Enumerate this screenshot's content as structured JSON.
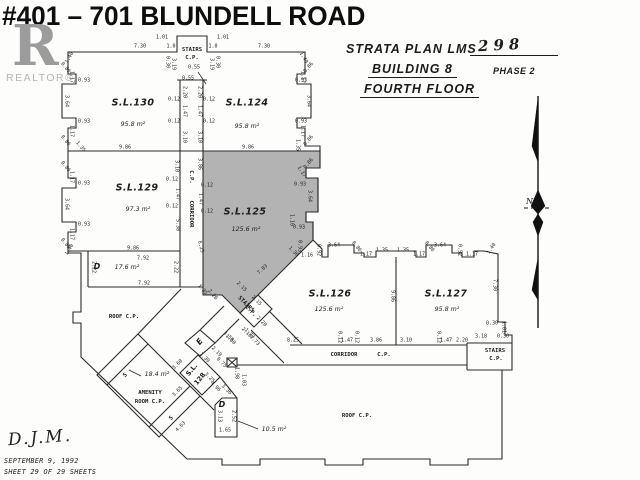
{
  "title": "#401 – 701 BLUNDELL ROAD",
  "logo": {
    "letter": "R",
    "brand": "REALTOR®"
  },
  "plan_header": {
    "line1_label": "STRATA PLAN LMS",
    "line1_value": "298",
    "line2": "BUILDING 8",
    "phase": "PHASE 2",
    "line3": "FOURTH FLOOR"
  },
  "footer": {
    "signature": "D.J.M.",
    "date": "SEPTEMBER 9, 1992",
    "sheet": "SHEET 29 OF 29 SHEETS"
  },
  "colors": {
    "ink": "#2b2b2b",
    "shaded_unit": "#b3b3b3",
    "logo_gray": "#9c9c9c"
  },
  "rooms": [
    {
      "name": "S.L.130",
      "area": "95.8 m²",
      "nx": 133,
      "ny": 103,
      "ax": 133,
      "ay": 125
    },
    {
      "name": "S.L.124",
      "area": "95.8 m²",
      "nx": 247,
      "ny": 103,
      "ax": 247,
      "ay": 127
    },
    {
      "name": "S.L.129",
      "area": "97.3 m²",
      "nx": 137,
      "ny": 188,
      "ax": 138,
      "ay": 210
    },
    {
      "name": "S.L.125",
      "area": "125.6 m²",
      "nx": 245,
      "ny": 212,
      "ax": 246,
      "ay": 230
    },
    {
      "name": "S.L.126",
      "area": "125.6 m²",
      "nx": 330,
      "ny": 294,
      "ax": 329,
      "ay": 310
    },
    {
      "name": "S.L.127",
      "area": "95.8 m²",
      "nx": 446,
      "ny": 294,
      "ax": 447,
      "ay": 310
    }
  ],
  "small_labels": [
    {
      "t": "STAIRS",
      "x": 192,
      "y": 51,
      "cls": "rm"
    },
    {
      "t": "C.P.",
      "x": 192,
      "y": 59,
      "cls": "rm"
    },
    {
      "t": "C.P.",
      "x": 190,
      "y": 177,
      "r": 90,
      "cls": "rm"
    },
    {
      "t": "CORRIDOR",
      "x": 190,
      "y": 214,
      "r": 90,
      "cls": "rm"
    },
    {
      "t": "CORRIDOR",
      "x": 344,
      "y": 356,
      "cls": "rm"
    },
    {
      "t": "C.P.",
      "x": 384,
      "y": 356,
      "cls": "rm"
    },
    {
      "t": "STAIRS",
      "x": 495,
      "y": 352,
      "cls": "rm"
    },
    {
      "t": "C.P.",
      "x": 496,
      "y": 360,
      "cls": "rm"
    },
    {
      "t": "STAIRS",
      "x": 245,
      "y": 305,
      "r": 45,
      "cls": "rm"
    },
    {
      "t": "C.P.",
      "x": 250,
      "y": 312,
      "r": 45,
      "cls": "rm"
    },
    {
      "t": "ROOF C.P.",
      "x": 124,
      "y": 318,
      "cls": "rm"
    },
    {
      "t": "ROOF C.P.",
      "x": 357,
      "y": 417,
      "cls": "rm"
    },
    {
      "t": "AMENITY",
      "x": 150,
      "y": 394,
      "cls": "rm"
    },
    {
      "t": "ROOM C.P.",
      "x": 150,
      "y": 403,
      "cls": "rm"
    },
    {
      "t": "18.4 m²",
      "x": 157,
      "y": 375,
      "cls": "area-sm"
    },
    {
      "t": "10.5 m²",
      "x": 274,
      "y": 430,
      "cls": "area-sm"
    },
    {
      "t": "17.6 m²",
      "x": 127,
      "y": 268,
      "cls": "area-sm"
    },
    {
      "t": "D",
      "x": 97,
      "y": 267,
      "cls": "bold"
    },
    {
      "t": "D",
      "x": 222,
      "y": 405,
      "cls": "bold"
    },
    {
      "t": "E",
      "x": 200,
      "y": 342,
      "r": -50,
      "cls": "bold"
    },
    {
      "t": "S.L.",
      "x": 192,
      "y": 370,
      "r": -50,
      "cls": "bold-sm"
    },
    {
      "t": "128",
      "x": 200,
      "y": 379,
      "r": -50,
      "cls": "bold-sm"
    },
    {
      "t": "S",
      "x": 126,
      "y": 376,
      "r": -45,
      "cls": "rm"
    },
    {
      "t": "S",
      "x": 172,
      "y": 419,
      "r": -45,
      "cls": "rm"
    }
  ],
  "dimensions": [
    {
      "t": "7.30",
      "x": 140,
      "y": 47
    },
    {
      "t": "1.01",
      "x": 162,
      "y": 38
    },
    {
      "t": "1.0",
      "x": 171,
      "y": 47
    },
    {
      "t": "0.30",
      "x": 167,
      "y": 62,
      "r": 90
    },
    {
      "t": "3.19",
      "x": 173,
      "y": 64,
      "r": 90
    },
    {
      "t": "3.19",
      "x": 211,
      "y": 64,
      "r": 90
    },
    {
      "t": "0.30",
      "x": 217,
      "y": 62,
      "r": 90
    },
    {
      "t": "1.0",
      "x": 213,
      "y": 47
    },
    {
      "t": "1.01",
      "x": 223,
      "y": 38
    },
    {
      "t": "7.30",
      "x": 264,
      "y": 47
    },
    {
      "t": "1.40",
      "x": 70,
      "y": 58,
      "r": -60
    },
    {
      "t": "1.40",
      "x": 303,
      "y": 58,
      "r": 60
    },
    {
      "t": "0.55",
      "x": 194,
      "y": 68
    },
    {
      "t": "0.55",
      "x": 188,
      "y": 79
    },
    {
      "t": "2.20",
      "x": 184,
      "y": 92,
      "r": 90
    },
    {
      "t": "2.20",
      "x": 199,
      "y": 92,
      "r": 90
    },
    {
      "t": "0.12",
      "x": 174,
      "y": 100
    },
    {
      "t": "0.12",
      "x": 209,
      "y": 100
    },
    {
      "t": "1.47",
      "x": 184,
      "y": 111,
      "r": 90
    },
    {
      "t": "1.47",
      "x": 199,
      "y": 111,
      "r": 90
    },
    {
      "t": "0.12",
      "x": 174,
      "y": 122
    },
    {
      "t": "0.12",
      "x": 209,
      "y": 122
    },
    {
      "t": "3.10",
      "x": 184,
      "y": 137,
      "r": 90
    },
    {
      "t": "3.10",
      "x": 199,
      "y": 137,
      "r": 90
    },
    {
      "t": "0.86",
      "x": 65,
      "y": 68,
      "r": 50
    },
    {
      "t": "1.17",
      "x": 71,
      "y": 77,
      "r": 90
    },
    {
      "t": "0.93",
      "x": 84,
      "y": 81
    },
    {
      "t": "3.64",
      "x": 66,
      "y": 101,
      "r": 90
    },
    {
      "t": "0.93",
      "x": 84,
      "y": 122
    },
    {
      "t": "1.17",
      "x": 71,
      "y": 131,
      "r": 90
    },
    {
      "t": "0.86",
      "x": 65,
      "y": 141,
      "r": 50
    },
    {
      "t": "1.35",
      "x": 80,
      "y": 147,
      "r": 50
    },
    {
      "t": "0.86",
      "x": 309,
      "y": 68,
      "r": -50
    },
    {
      "t": "1.17",
      "x": 302,
      "y": 77,
      "r": 90
    },
    {
      "t": "0.93",
      "x": 301,
      "y": 81
    },
    {
      "t": "3.64",
      "x": 308,
      "y": 101,
      "r": 90
    },
    {
      "t": "0.93",
      "x": 301,
      "y": 122
    },
    {
      "t": "1.17",
      "x": 302,
      "y": 131,
      "r": 90
    },
    {
      "t": "0.86",
      "x": 309,
      "y": 141,
      "r": -50
    },
    {
      "t": "1.35",
      "x": 297,
      "y": 145,
      "r": 90
    },
    {
      "t": "9.86",
      "x": 125,
      "y": 148
    },
    {
      "t": "9.86",
      "x": 248,
      "y": 148
    },
    {
      "t": "0.86",
      "x": 65,
      "y": 167,
      "r": 50
    },
    {
      "t": "1.17",
      "x": 71,
      "y": 177,
      "r": 90
    },
    {
      "t": "0.93",
      "x": 84,
      "y": 184
    },
    {
      "t": "3.64",
      "x": 66,
      "y": 204,
      "r": 90
    },
    {
      "t": "0.93",
      "x": 84,
      "y": 225
    },
    {
      "t": "1.17",
      "x": 71,
      "y": 234,
      "r": 90
    },
    {
      "t": "0.86",
      "x": 65,
      "y": 244,
      "r": 50
    },
    {
      "t": "1.40",
      "x": 70,
      "y": 250,
      "r": -60
    },
    {
      "t": "3.10",
      "x": 176,
      "y": 166,
      "r": 90
    },
    {
      "t": "3.86",
      "x": 199,
      "y": 164,
      "r": 90
    },
    {
      "t": "0.12",
      "x": 172,
      "y": 180
    },
    {
      "t": "0.12",
      "x": 207,
      "y": 186
    },
    {
      "t": "1.47",
      "x": 177,
      "y": 194,
      "r": 90
    },
    {
      "t": "1.47",
      "x": 200,
      "y": 199,
      "r": 90
    },
    {
      "t": "0.12",
      "x": 172,
      "y": 207
    },
    {
      "t": "0.12",
      "x": 207,
      "y": 212
    },
    {
      "t": "5.38",
      "x": 177,
      "y": 225,
      "r": 90
    },
    {
      "t": "6.25",
      "x": 200,
      "y": 247,
      "r": 75
    },
    {
      "t": "0.86",
      "x": 309,
      "y": 164,
      "r": -50
    },
    {
      "t": "1.17",
      "x": 301,
      "y": 172,
      "r": 60
    },
    {
      "t": "0.93",
      "x": 300,
      "y": 185
    },
    {
      "t": "3.64",
      "x": 309,
      "y": 196,
      "r": 90
    },
    {
      "t": "1.16",
      "x": 291,
      "y": 220,
      "r": 90
    },
    {
      "t": "0.93",
      "x": 299,
      "y": 228
    },
    {
      "t": "7.83",
      "x": 263,
      "y": 270,
      "r": -44
    },
    {
      "t": "1.35",
      "x": 202,
      "y": 290,
      "r": 50
    },
    {
      "t": "2.20",
      "x": 212,
      "y": 295,
      "r": 50
    },
    {
      "t": "2.15",
      "x": 241,
      "y": 287,
      "r": 45
    },
    {
      "t": "2.15",
      "x": 256,
      "y": 301,
      "r": 45
    },
    {
      "t": "2.20",
      "x": 261,
      "y": 322,
      "r": 45
    },
    {
      "t": "2.10",
      "x": 246,
      "y": 333,
      "r": 45
    },
    {
      "t": "1.73",
      "x": 254,
      "y": 341,
      "r": 45
    },
    {
      "t": "1.50",
      "x": 228,
      "y": 337,
      "r": 45
    },
    {
      "t": "1.36",
      "x": 293,
      "y": 252,
      "r": 45
    },
    {
      "t": "1.16",
      "x": 307,
      "y": 256
    },
    {
      "t": "0.93",
      "x": 299,
      "y": 246,
      "r": 90
    },
    {
      "t": "0.92",
      "x": 318,
      "y": 250,
      "r": 90
    },
    {
      "t": "3.64",
      "x": 334,
      "y": 246
    },
    {
      "t": "0.86",
      "x": 356,
      "y": 247,
      "r": 50
    },
    {
      "t": "1.17",
      "x": 366,
      "y": 255
    },
    {
      "t": "1.35",
      "x": 382,
      "y": 251
    },
    {
      "t": "1.35",
      "x": 403,
      "y": 251
    },
    {
      "t": "1.17",
      "x": 419,
      "y": 255
    },
    {
      "t": "0.86",
      "x": 429,
      "y": 247,
      "r": 50
    },
    {
      "t": "3.64",
      "x": 440,
      "y": 246
    },
    {
      "t": "0.92",
      "x": 459,
      "y": 250,
      "r": 90
    },
    {
      "t": "1.17",
      "x": 472,
      "y": 255
    },
    {
      "t": "1.40",
      "x": 492,
      "y": 249,
      "r": -55
    },
    {
      "t": "9.86",
      "x": 392,
      "y": 296,
      "r": 90
    },
    {
      "t": "7.30",
      "x": 494,
      "y": 285,
      "r": 90
    },
    {
      "t": "8.25",
      "x": 293,
      "y": 341
    },
    {
      "t": "0.12",
      "x": 339,
      "y": 337,
      "r": 90
    },
    {
      "t": "1.47",
      "x": 347,
      "y": 341
    },
    {
      "t": "0.12",
      "x": 356,
      "y": 337,
      "r": 90
    },
    {
      "t": "3.86",
      "x": 376,
      "y": 341
    },
    {
      "t": "3.10",
      "x": 406,
      "y": 341
    },
    {
      "t": "0.12",
      "x": 438,
      "y": 337,
      "r": 90
    },
    {
      "t": "1.47",
      "x": 446,
      "y": 341
    },
    {
      "t": "2.20",
      "x": 462,
      "y": 341
    },
    {
      "t": "3.18",
      "x": 481,
      "y": 337
    },
    {
      "t": "0.30",
      "x": 492,
      "y": 324
    },
    {
      "t": "1.01",
      "x": 503,
      "y": 327,
      "r": 90
    },
    {
      "t": "0.30",
      "x": 503,
      "y": 337
    },
    {
      "t": "2.22",
      "x": 93,
      "y": 267,
      "r": 90
    },
    {
      "t": "7.92",
      "x": 143,
      "y": 259
    },
    {
      "t": "2.22",
      "x": 175,
      "y": 267,
      "r": 90
    },
    {
      "t": "7.92",
      "x": 144,
      "y": 284
    },
    {
      "t": "9.86",
      "x": 133,
      "y": 249
    },
    {
      "t": "3.60",
      "x": 178,
      "y": 365,
      "r": -45
    },
    {
      "t": "1.39",
      "x": 204,
      "y": 358,
      "r": 45
    },
    {
      "t": "2.19",
      "x": 216,
      "y": 352,
      "r": 45
    },
    {
      "t": "0.75",
      "x": 221,
      "y": 363,
      "r": 45
    },
    {
      "t": "3.25",
      "x": 209,
      "y": 378,
      "r": 45
    },
    {
      "t": "4.96",
      "x": 215,
      "y": 387,
      "r": 45
    },
    {
      "t": "3.36",
      "x": 226,
      "y": 390,
      "r": 45
    },
    {
      "t": "1.98",
      "x": 236,
      "y": 373,
      "r": 90
    },
    {
      "t": "1.03",
      "x": 243,
      "y": 380,
      "r": 90
    },
    {
      "t": "3.65",
      "x": 178,
      "y": 392,
      "r": -45
    },
    {
      "t": "1.73",
      "x": 249,
      "y": 334,
      "r": 45
    },
    {
      "t": "1.50",
      "x": 230,
      "y": 340,
      "r": 45
    },
    {
      "t": "4.63",
      "x": 181,
      "y": 427,
      "r": -45
    },
    {
      "t": "3.13",
      "x": 219,
      "y": 416,
      "r": 90
    },
    {
      "t": "2.52",
      "x": 233,
      "y": 416,
      "r": 90
    },
    {
      "t": "1.65",
      "x": 225,
      "y": 431
    }
  ]
}
